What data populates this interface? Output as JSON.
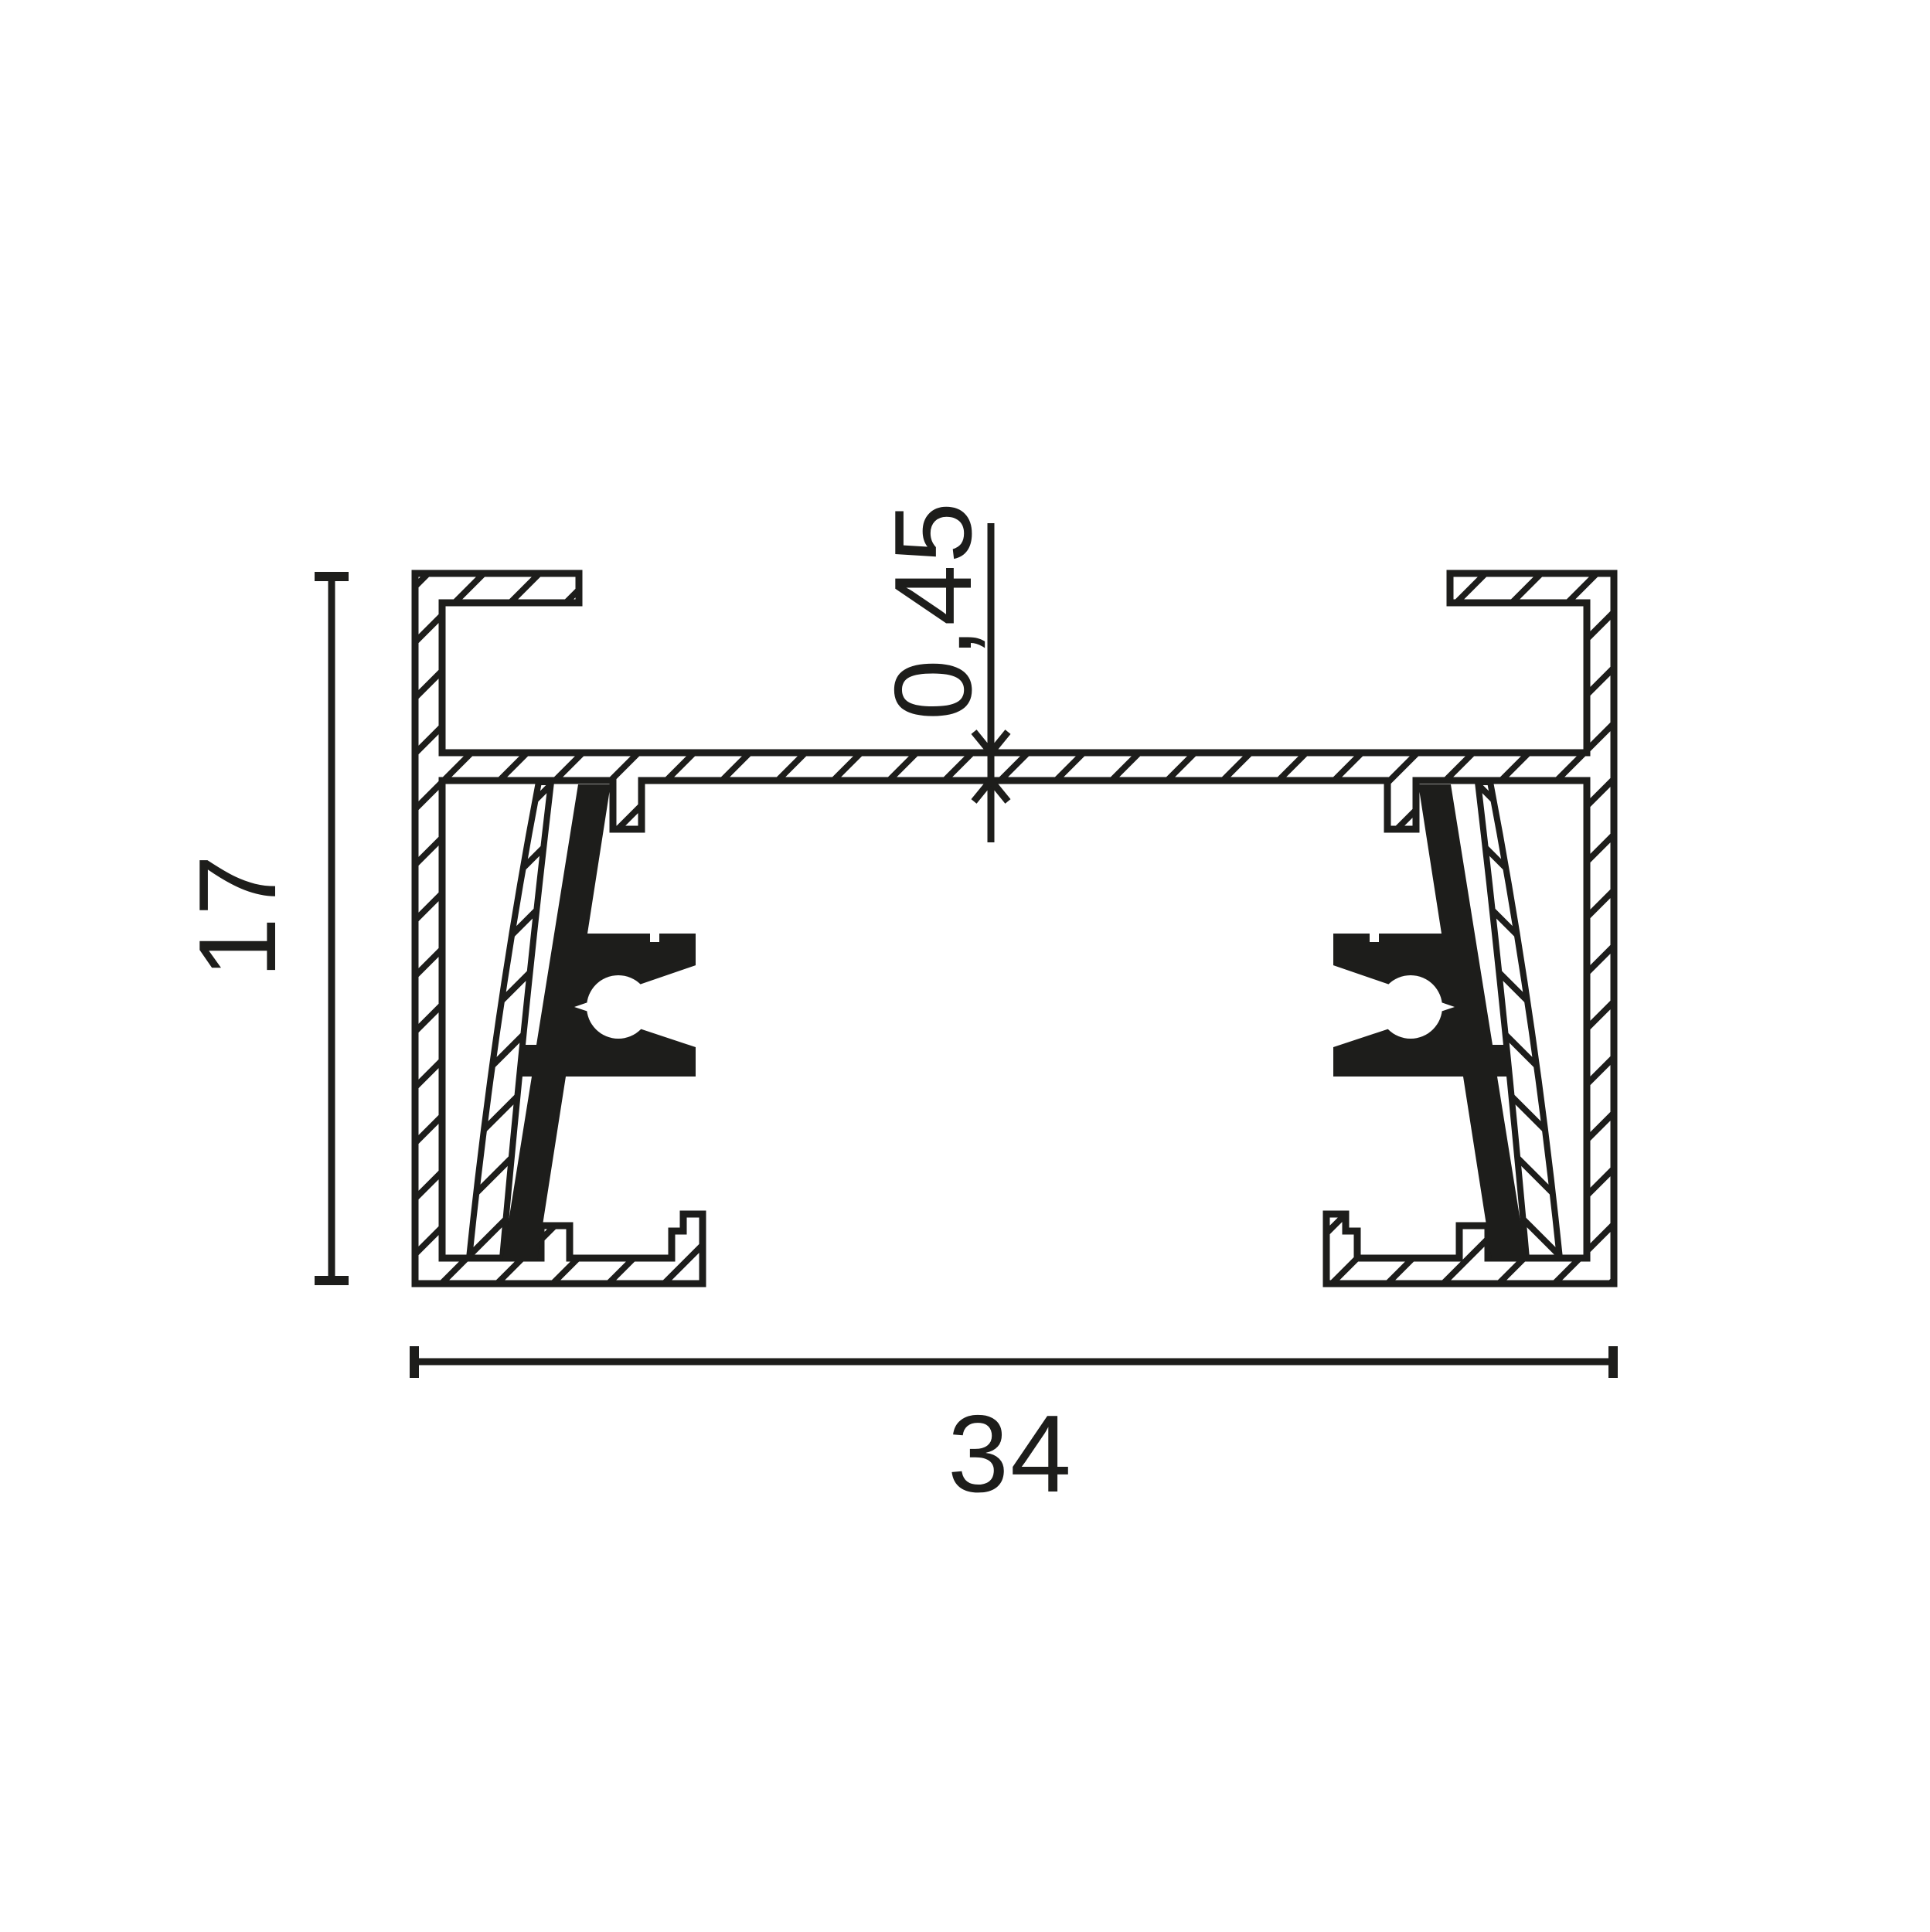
{
  "diagram": {
    "type": "technical-cross-section",
    "subject": "track-profile",
    "dimensions": {
      "height": {
        "value": "17"
      },
      "width": {
        "value": "34"
      },
      "web_thickness": {
        "value": "0,45"
      }
    },
    "colors": {
      "ink": "#1d1d1b",
      "background": "#ffffff"
    }
  }
}
